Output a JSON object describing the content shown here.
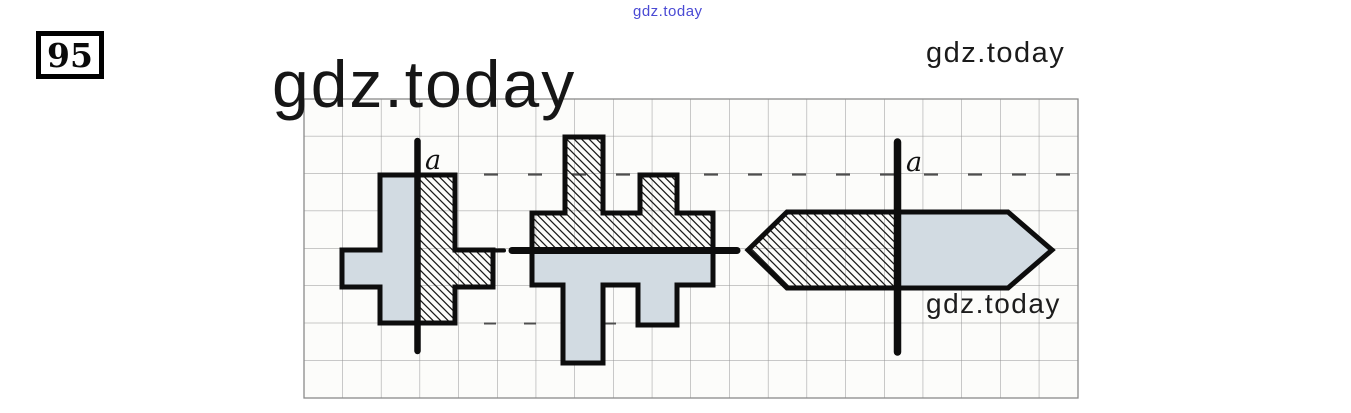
{
  "header": {
    "site_link": "gdz.today",
    "exercise_number": "95",
    "watermark_big": "gdz.today",
    "watermark_top_right": "gdz.today"
  },
  "footer": {
    "watermark_bottom_right": "gdz.today"
  },
  "diagram": {
    "paper": "square grid",
    "figures": [
      {
        "name": "cross-shape",
        "axis_orientation": "vertical",
        "axis_label": "a",
        "left_half": "plain pale-blue fill",
        "right_half": "diagonal hatching"
      },
      {
        "name": "double-T-shape",
        "axis_orientation": "horizontal",
        "axis_label": "",
        "top_half": "diagonal hatching",
        "bottom_half": "plain pale-blue fill"
      },
      {
        "name": "arrow-hexagon",
        "axis_orientation": "vertical",
        "axis_label": "a",
        "left_half": "diagonal hatching",
        "right_half": "plain pale-blue fill"
      }
    ]
  },
  "colors": {
    "figure_fill_blue": "#d2dbe2",
    "outline_black": "#0d0d0d",
    "hatch_line": "#1a1a1a",
    "grid_line": "#949494",
    "grid_background": "#fcfcfa",
    "link_blue": "#4a4ad4",
    "watermark_dark": "#1b1b1b"
  }
}
